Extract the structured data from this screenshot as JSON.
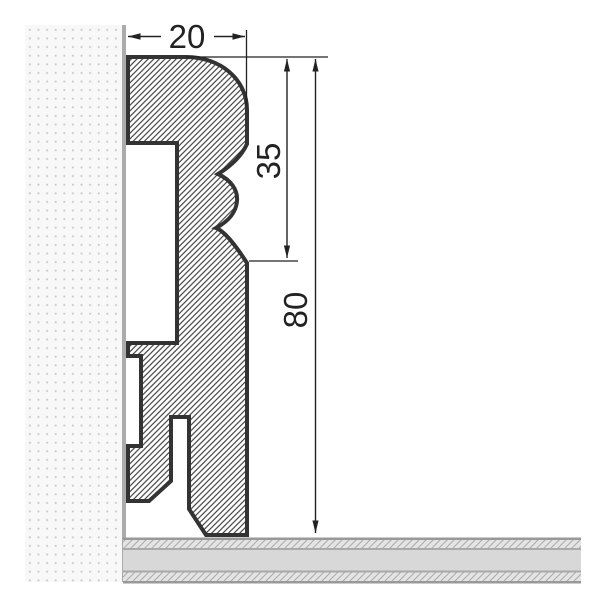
{
  "drawing": {
    "type": "technical-cross-section",
    "subject": "skirting-board-profile-on-wall-and-floor",
    "labels": {
      "width": "20",
      "upper_height": "35",
      "total_height": "80"
    },
    "colors": {
      "outline": "#333333",
      "dimension": "#222222",
      "hatch_line": "#3d3d3d",
      "wall_dot": "#c6c6c6",
      "wall_background": "#f8f8f8",
      "wall_edge": "#ababab",
      "floor_line": "#999999",
      "floor_core": "#d8d8d8",
      "floor_hatch_background": "#e4e4e4",
      "floor_hatch_line": "#ababab",
      "background": "#ffffff"
    }
  }
}
